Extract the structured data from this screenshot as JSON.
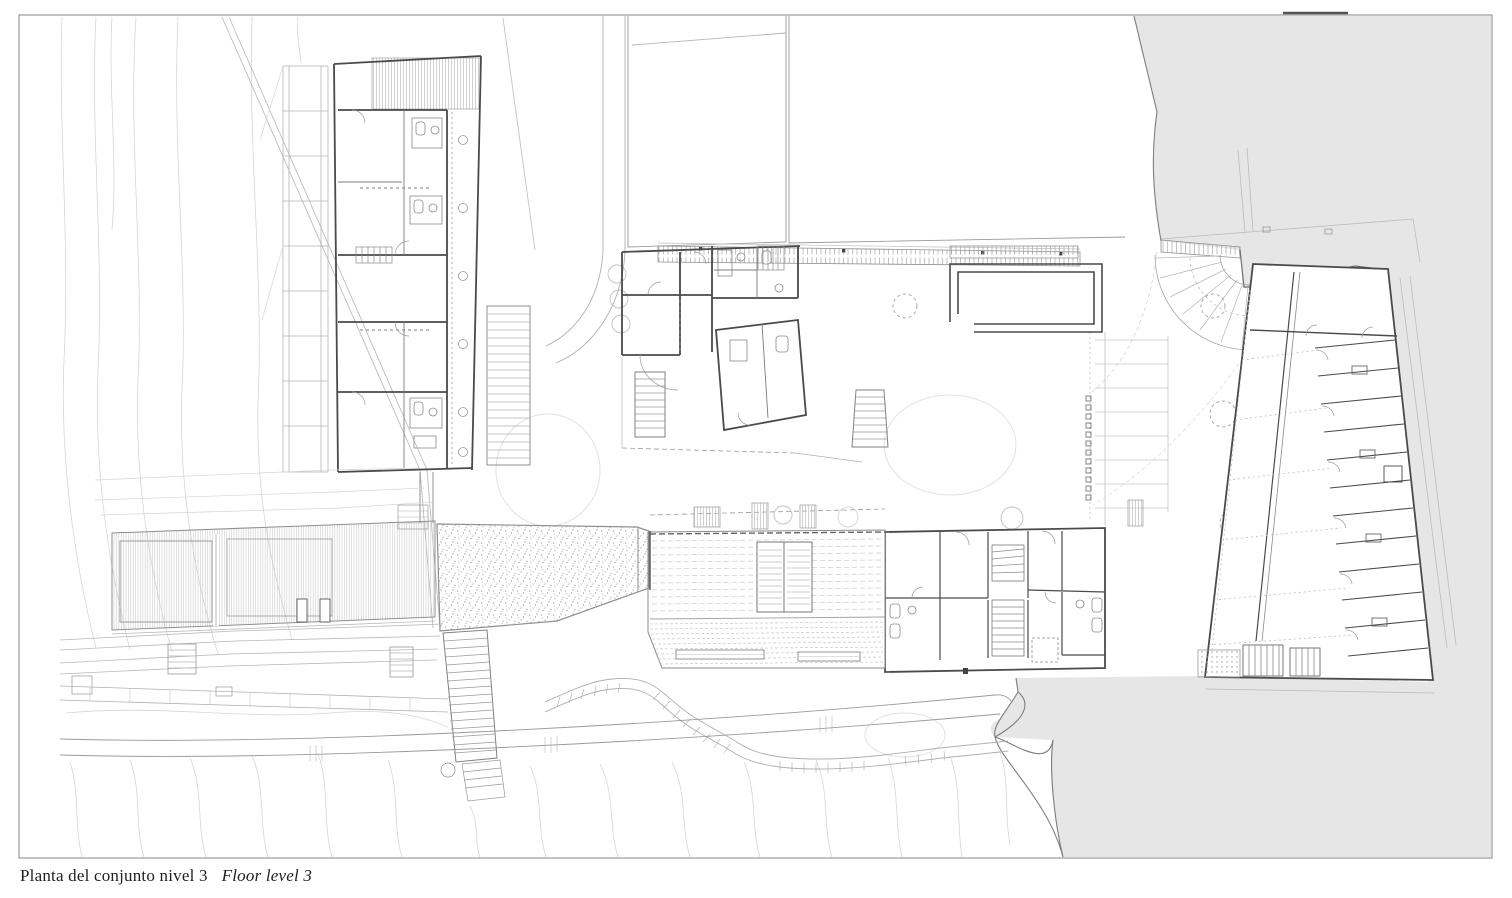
{
  "caption": {
    "primary": "Planta del conjunto nivel 3",
    "secondary": "Floor level 3"
  },
  "colors": {
    "paper": "#ffffff",
    "water": "#e6e6e6",
    "coast_line": "#7d7d7d",
    "wall_line": "#4a4a4a",
    "medium_line": "#9a9a9a",
    "light_line": "#c9c9c9",
    "contour_line": "#d6d6d6",
    "frame_line": "#8f8f8f",
    "caption_text": "#1f1f1f"
  }
}
